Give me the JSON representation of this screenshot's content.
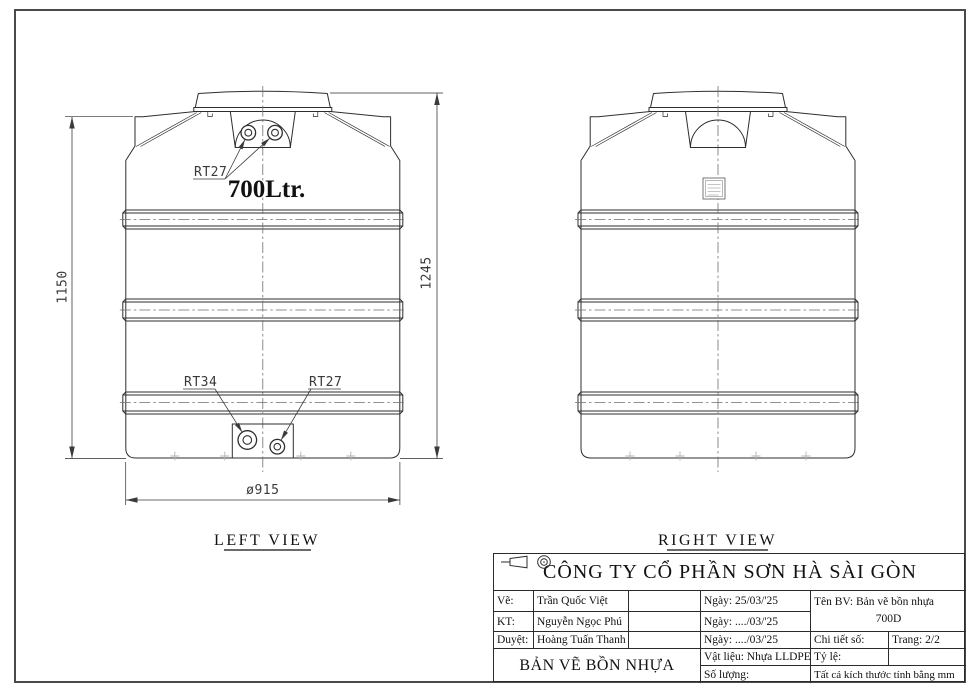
{
  "colors": {
    "background": "#ffffff",
    "ink": "#2e2e2e",
    "muted_marks": "#b4b4b4"
  },
  "drawing": {
    "views": [
      {
        "label": "LEFT VIEW",
        "capacity": "700Ltr.",
        "fitting_labels": {
          "top": "RT27",
          "bottom_left": "RT34",
          "bottom_right": "RT27"
        }
      },
      {
        "label": "RIGHT VIEW"
      }
    ],
    "dimensions": {
      "body_height": "1150",
      "overall_height": "1245",
      "diameter": "ø915"
    }
  },
  "title_block": {
    "company": "CÔNG TY CỔ PHẦN SƠN HÀ SÀI GÒN",
    "rows": [
      {
        "role": "Vẽ:",
        "name": "Trần Quốc Việt",
        "date": "Ngày: 25/03/'25"
      },
      {
        "role": "KT:",
        "name": "Nguyễn Ngọc Phú",
        "date": "Ngày: ..../03/'25"
      },
      {
        "role": "Duyệt:",
        "name": "Hoàng Tuấn Thanh",
        "date": "Ngày: ..../03/'25"
      }
    ],
    "drawing_name": "Tên BV: Bản vẽ bồn nhựa",
    "drawing_code": "700D",
    "detail_no_label": "Chi tiết số:",
    "page_label": "Trang: 2/2",
    "material": "Vật liệu: Nhựa LLDPE",
    "quantity_label": "Số lượng:",
    "scale_label": "Tỷ lệ:",
    "sheet_title": "BẢN VẼ BỒN NHỰA",
    "units_note": "Tất cả kích thước tính bằng mm"
  }
}
